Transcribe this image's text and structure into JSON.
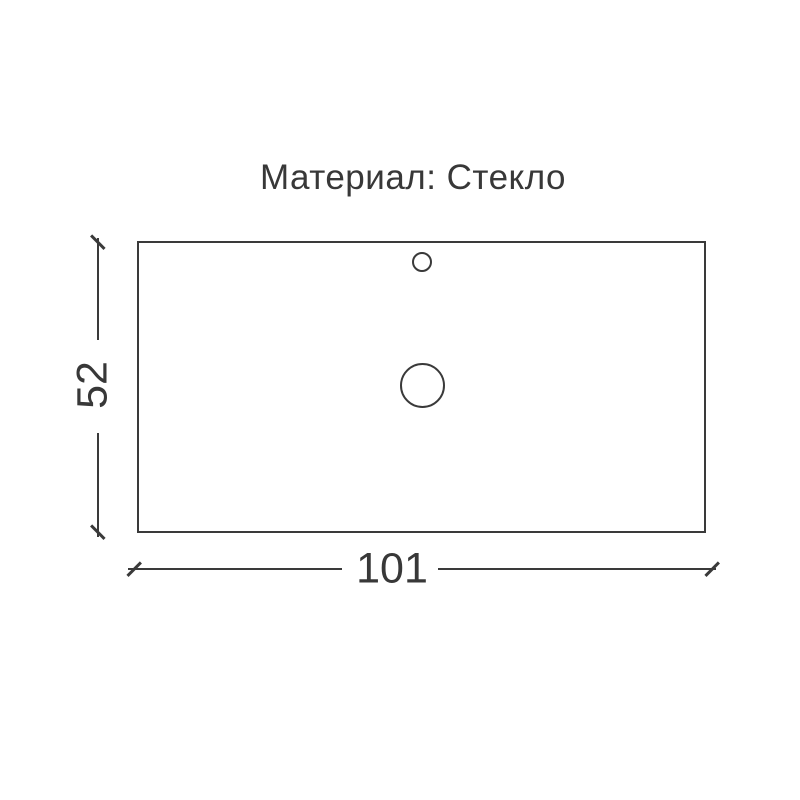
{
  "title": "Материал: Стекло",
  "dimensions": {
    "width": "101",
    "height": "52"
  },
  "colors": {
    "background": "#ffffff",
    "line": "#3a3a3a",
    "text": "#383838"
  }
}
